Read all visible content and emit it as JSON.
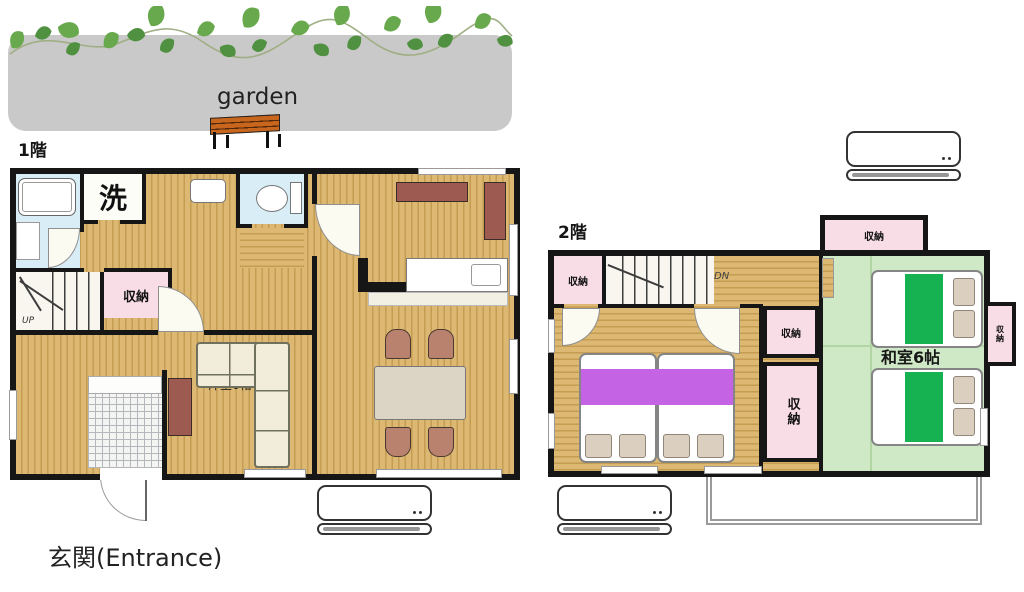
{
  "garden": {
    "label": "garden"
  },
  "floor1": {
    "label": "1階",
    "laundry_label": "洗",
    "storage_label": "収納",
    "stairs_label": "UP",
    "room_label": "洋室6帖",
    "entrance_label": "玄関(Entrance)"
  },
  "floor2": {
    "label": "2階",
    "stairs_label": "DN",
    "storage_label": "収納",
    "japanese_room_label": "和室6帖"
  },
  "colors": {
    "wall": "#161616",
    "wood": "#dcb873",
    "wood_line": "#c49c52",
    "water": "#d8edf5",
    "pink": "#f8dde6",
    "tatami": "#cfe8c5",
    "tatami_line": "#b2d5a4",
    "bed_green": "#16b150",
    "purple": "#c464e4",
    "brown": "#9c5a50",
    "chair": "#b8826f",
    "sofa": "#f2ecdb",
    "table": "#dcd4c4",
    "pillow": "#dbcfbf",
    "garden_gray": "#c9c9c9",
    "bench": "#c9661e",
    "vine": "#68a94d",
    "stepbg": "#f8f6ee",
    "doorbg": "#fcfbf2"
  }
}
